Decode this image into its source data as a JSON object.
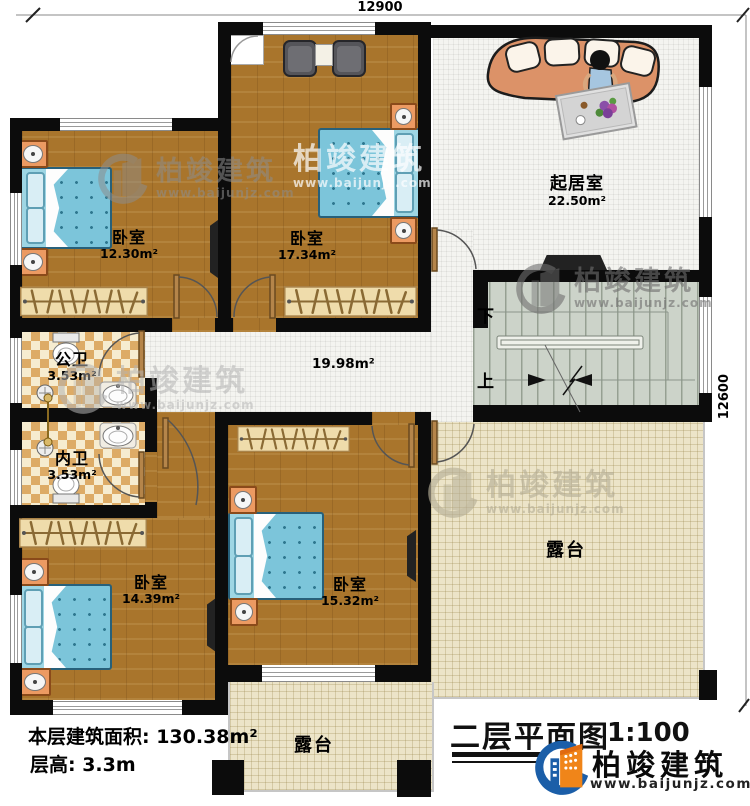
{
  "dimensions": {
    "top": "12900",
    "right": "12600"
  },
  "rooms": {
    "bedroom_tl": {
      "label": "卧室",
      "area": "12.30m²"
    },
    "bedroom_tm": {
      "label": "卧室",
      "area": "17.34m²"
    },
    "living": {
      "label": "起居室",
      "area": "22.50m²"
    },
    "bath_public": {
      "label": "公卫",
      "area": "3.53m²"
    },
    "bath_private": {
      "label": "内卫",
      "area": "3.53m²"
    },
    "bedroom_bl": {
      "label": "卧室",
      "area": "14.39m²"
    },
    "bedroom_bm": {
      "label": "卧室",
      "area": "15.32m²"
    },
    "hallway": {
      "area": "19.98m²"
    },
    "terrace_right": {
      "label": "露台"
    },
    "terrace_bottom": {
      "label": "露台"
    }
  },
  "stairs": {
    "down": "下",
    "up": "上"
  },
  "footer": {
    "area_label": "本层建筑面积: 130.38m²",
    "height_label": "层高: 3.3m",
    "title": "二层平面图",
    "scale": "1:100"
  },
  "brand": {
    "name": "柏竣建筑",
    "website": "www.baijunjz.com"
  },
  "watermark": {
    "name": "柏竣建筑",
    "website": "www.baijunjz.com"
  },
  "colors": {
    "wall": "#0c0c0c",
    "wood_floor": "#a9752c",
    "bed": "#7cc5da",
    "bath_tile": "#ddab66",
    "terrace_floor": "#ece4c8",
    "stairs_floor": "#ccd3c9",
    "brand_blue": "#1b5ea8",
    "brand_orange": "#f08519"
  }
}
